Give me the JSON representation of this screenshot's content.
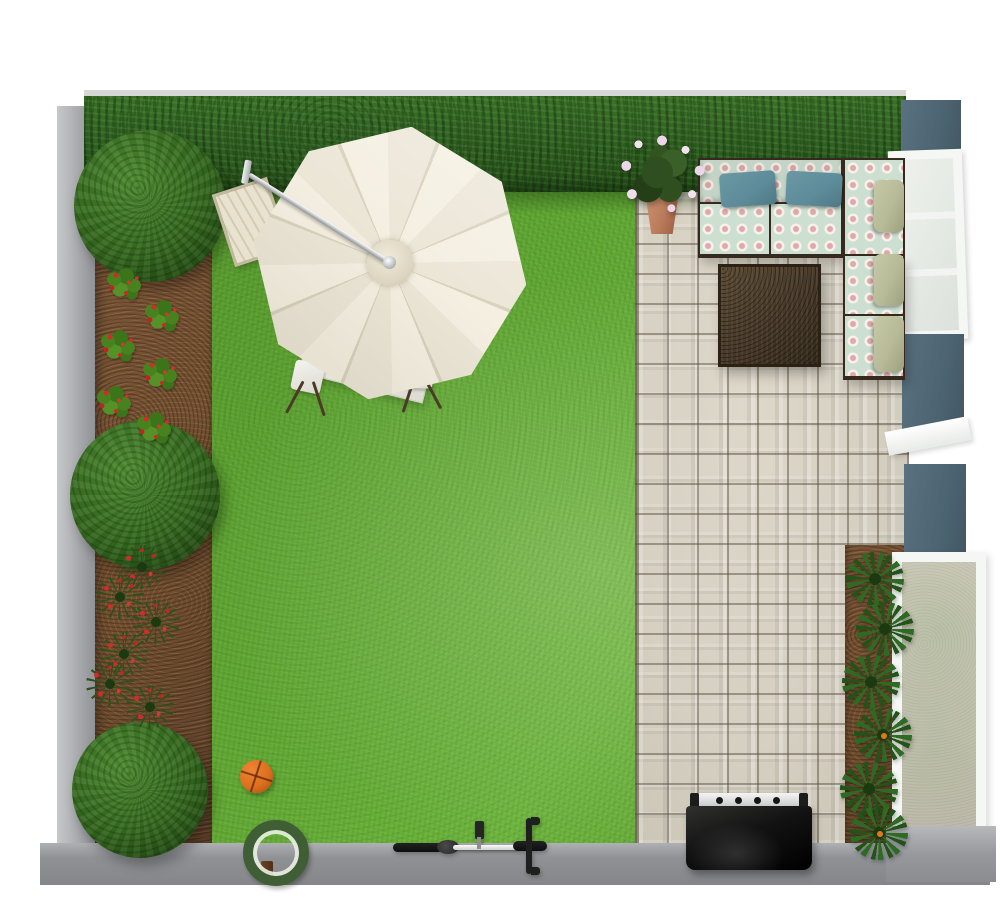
{
  "meta": {
    "title": "Backyard garden 3D top-view plan render",
    "canvas_width": 1000,
    "canvas_height": 907
  },
  "colors": {
    "lawn": "#61a833",
    "hedge": "#2e6020",
    "soil": "#74502f",
    "paver": "#d6d0c2",
    "wall_gray": "#909296",
    "wall_teal": "#4d6572",
    "window_white": "#f5f7f4",
    "glass": "#e6eae5",
    "stucco": "#cbc5b8",
    "bush": "#35691f",
    "plant_spike": "#2c511c",
    "tropical": "#2e6b22",
    "berry": "#d32a2a",
    "flower_pink": "#eed6ea",
    "umbrella_cream": "#f4efe1",
    "umbrella_shade": "#ece6d7",
    "seam": "#d8d1bd",
    "table_white": "#eceae4",
    "sofa_frame": "#352a1d",
    "cushion_mint": "#cddfd0",
    "medallion_pink": "#e2a8a8",
    "pillow_teal": "#5d8b99",
    "cushion_sage": "#b7ba97",
    "wicker": "#463828",
    "pot": "#b97a5a",
    "grill_black": "#121212",
    "steel": "#c7c8ca",
    "basketball": "#dd6f1e",
    "bike_dark": "#0e0e0e",
    "bike_white": "#cfcfcf"
  },
  "objects": {
    "lawn": {
      "label": "Grass lawn, centre-left of garden"
    },
    "patio": {
      "label": "Stone paver patio, right side"
    },
    "hedge": {
      "label": "Boxwood hedge along top boundary"
    },
    "left_wall": {
      "label": "Gray concrete wall, left boundary"
    },
    "bottom_wall": {
      "label": "Gray concrete wall, bottom boundary"
    },
    "house_wall": {
      "label": "Teal house wall with white windows, right side"
    },
    "window_top": {
      "label": "White-framed window, top right"
    },
    "window_sill": {
      "label": "White window sill, middle right"
    },
    "patio_door": {
      "label": "White-framed glass door with stucco reveal, lower right"
    },
    "left_flower_bed": {
      "label": "Soil flower bed with strawberry plants and red flower clumps",
      "bushes": 3,
      "strawberry_plants": 6,
      "red_flower_clumps": 6
    },
    "right_planting_bed": {
      "label": "Soil bed with tropical plants along house wall",
      "plants": 6
    },
    "topiary_bush": {
      "label": "Round topiary bush"
    },
    "umbrella": {
      "label": "Cream octagonal cantilever patio umbrella"
    },
    "dining_table": {
      "label": "White folding table under umbrella"
    },
    "chair": {
      "label": "Folding chair with pale seat",
      "count": 2
    },
    "lounger": {
      "label": "Wooden slat sun lounger"
    },
    "sofa": {
      "label": "L-shaped outdoor sectional sofa with mint medallion-pattern cushions",
      "throw_pillows": 2,
      "back_cushions": 3
    },
    "coffee_table": {
      "label": "Dark brown wicker coffee table"
    },
    "potted_plant": {
      "label": "Terracotta pot with pink flowering plant"
    },
    "grill": {
      "label": "Black barbecue grill with steel shelf",
      "knobs": 4
    },
    "basketball": {
      "label": "Orange basketball on lawn"
    },
    "ornament": {
      "label": "Round topiary wreath garden ornament on stand"
    },
    "bicycle": {
      "label": "Bicycle lying along bottom wall"
    }
  }
}
